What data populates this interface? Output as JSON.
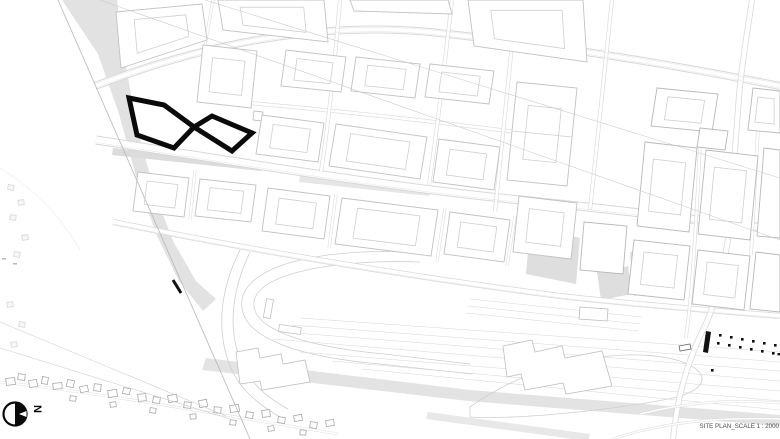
{
  "drawing": {
    "type": "architectural site plan",
    "scale_label": "SITE PLAN_SCALE 1 : 2000",
    "highlighted_building": "figure-eight (infinity loop) building outline",
    "north_arrow_letter": "N"
  },
  "colors": {
    "highlight_black": "#0a0a0a",
    "park_fill": "#e2e2e2",
    "plaza_fill": "#dedede",
    "rail_corridor_fill": "#e3e3e3",
    "block_outline": "#c2c2c2",
    "street_edge": "#d8d8d8",
    "label_text": "#4a4a4a"
  },
  "markers": {
    "tram_stop_dots_upper_row": 6,
    "tram_stop_dots_lower_row": 7
  }
}
